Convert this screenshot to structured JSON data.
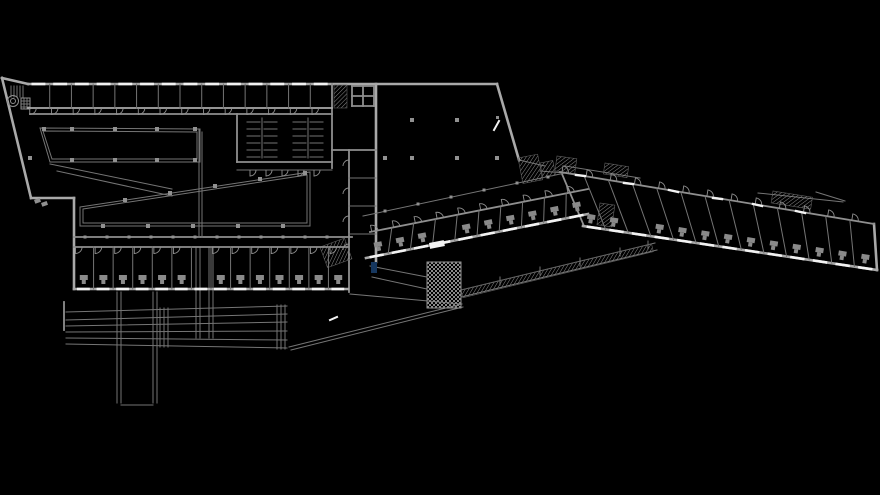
{
  "canvas": {
    "w": 880,
    "h": 495,
    "bg": "#000000"
  },
  "palette": {
    "thick": "#a9a9a9",
    "med": "#8f8f8f",
    "thin": "#757575",
    "faint": "#5e5e5e",
    "white": "#f2f2f2",
    "column": "#919191",
    "fixture": "#8a8a8a",
    "navy": "#16375f",
    "hatch": "#8a8a8a"
  },
  "walls": {
    "thick": [
      [
        2,
        78,
        28,
        84
      ],
      [
        28,
        84,
        497,
        84
      ],
      [
        2,
        78,
        31,
        198
      ],
      [
        31,
        198,
        74,
        198
      ],
      [
        74,
        198,
        74,
        289
      ],
      [
        497,
        84,
        519,
        160
      ],
      [
        376,
        84,
        376,
        262
      ],
      [
        874,
        224,
        877,
        270
      ]
    ],
    "med": [
      [
        30,
        114,
        332,
        114
      ],
      [
        237,
        114,
        237,
        162
      ],
      [
        237,
        162,
        332,
        162
      ],
      [
        332,
        84,
        332,
        168
      ],
      [
        332,
        150,
        376,
        150
      ],
      [
        349,
        150,
        349,
        292
      ],
      [
        74,
        237,
        352,
        237
      ],
      [
        64,
        302,
        64,
        330
      ],
      [
        562,
        174,
        584,
        226
      ],
      [
        352,
        86,
        352,
        106
      ],
      [
        374,
        86,
        374,
        106
      ],
      [
        352,
        86,
        374,
        86
      ],
      [
        352,
        106,
        374,
        106
      ],
      [
        363,
        86,
        363,
        106
      ],
      [
        352,
        96,
        374,
        96
      ]
    ],
    "thin": [
      [
        237,
        170,
        332,
        170
      ],
      [
        349,
        178,
        376,
        178
      ],
      [
        349,
        206,
        376,
        206
      ],
      [
        349,
        234,
        376,
        234
      ],
      [
        117,
        292,
        117,
        403
      ],
      [
        121,
        292,
        121,
        403
      ],
      [
        153,
        292,
        153,
        403
      ],
      [
        157,
        292,
        157,
        403
      ],
      [
        121,
        405,
        153,
        405
      ],
      [
        196,
        247,
        196,
        338
      ],
      [
        200,
        247,
        200,
        338
      ],
      [
        209,
        247,
        209,
        338
      ],
      [
        213,
        247,
        213,
        338
      ],
      [
        66,
        312,
        287,
        306
      ],
      [
        66,
        320,
        287,
        314
      ],
      [
        66,
        326,
        287,
        322
      ],
      [
        66,
        332,
        287,
        331
      ],
      [
        66,
        338,
        287,
        340
      ],
      [
        66,
        344,
        287,
        348
      ],
      [
        160,
        308,
        160,
        347
      ],
      [
        164,
        308,
        164,
        347
      ],
      [
        168,
        308,
        168,
        347
      ],
      [
        277,
        305,
        277,
        349
      ],
      [
        281,
        305,
        281,
        349
      ],
      [
        285,
        305,
        285,
        349
      ],
      [
        289,
        347,
        462,
        304
      ],
      [
        291,
        350,
        463,
        307
      ],
      [
        350,
        294,
        461,
        304
      ],
      [
        461,
        290,
        655,
        243
      ],
      [
        461,
        297,
        657,
        250
      ],
      [
        370,
        266,
        427,
        277
      ],
      [
        372,
        277,
        427,
        289
      ],
      [
        363,
        216,
        565,
        173
      ],
      [
        540,
        171,
        565,
        173
      ],
      [
        565,
        166,
        640,
        178
      ],
      [
        758,
        193,
        843,
        202
      ],
      [
        816,
        192,
        845,
        201
      ],
      [
        50,
        164,
        172,
        189
      ],
      [
        57,
        171,
        172,
        196
      ],
      [
        199,
        129,
        199,
        237
      ],
      [
        202,
        132,
        202,
        237
      ],
      [
        519,
        160,
        545,
        166
      ],
      [
        11,
        86,
        11,
        97
      ],
      [
        14,
        86,
        14,
        97
      ],
      [
        17,
        86,
        17,
        97
      ],
      [
        20,
        86,
        20,
        97
      ],
      [
        23,
        86,
        23,
        97
      ],
      [
        24,
        98,
        24,
        109
      ],
      [
        27,
        98,
        27,
        109
      ],
      [
        21,
        101,
        30,
        101
      ],
      [
        21,
        104,
        30,
        104
      ],
      [
        21,
        107,
        30,
        107
      ],
      [
        500,
        277,
        500,
        285
      ],
      [
        540,
        267,
        540,
        275
      ],
      [
        580,
        258,
        580,
        266
      ],
      [
        620,
        248,
        620,
        256
      ],
      [
        648,
        241,
        648,
        249
      ]
    ]
  },
  "bands": [
    {
      "name": "top-room-band",
      "top": [
        28,
        84,
        332,
        84
      ],
      "bottom": [
        28,
        108,
        332,
        108
      ],
      "n": 14,
      "topW": 0,
      "bottomW": 1.8,
      "doors": {
        "side": "bottom",
        "dir": "down",
        "skip": []
      },
      "windows": {
        "side": "top"
      },
      "fixtures": false
    },
    {
      "name": "left-wing-band",
      "top": [
        74,
        247,
        348,
        247
      ],
      "bottom": [
        74,
        289,
        348,
        289
      ],
      "n": 14,
      "topW": 1.8,
      "bottomW": 2.6,
      "doors": {
        "side": "top",
        "dir": "down",
        "skip": [
          6
        ]
      },
      "windows": {
        "side": "bottom"
      },
      "fixtures": {
        "skip": [
          6
        ]
      }
    },
    {
      "name": "middle-wing-band",
      "top": [
        370,
        232,
        588,
        189
      ],
      "bottom": [
        366,
        258,
        588,
        214
      ],
      "n": 10,
      "topW": 1.8,
      "bottomW": 2.6,
      "doors": {
        "side": "top",
        "dir": "up",
        "skip": []
      },
      "windows": {
        "side": "bottom"
      },
      "fixtures": {
        "skip": [
          3
        ]
      }
    },
    {
      "name": "right-wing-band",
      "top": [
        560,
        172,
        874,
        224
      ],
      "bottom": [
        583,
        226,
        877,
        270
      ],
      "n": 13,
      "topW": 1.8,
      "bottomW": 2.6,
      "doors": {
        "side": "top",
        "dir": "up",
        "skip": []
      },
      "windows": {
        "side": "bottom"
      },
      "fixtures": {
        "skip": [
          2
        ]
      }
    }
  ],
  "stalls": {
    "ys": [
      122,
      129,
      136,
      143,
      150,
      157
    ],
    "vy1": 118,
    "vy2": 158,
    "groups": [
      {
        "cx": 262,
        "x1": 247,
        "x2": 277
      },
      {
        "cx": 308,
        "x1": 293,
        "x2": 323
      }
    ]
  },
  "doors_extra": [
    [
      250,
      170,
      6,
      0,
      "down"
    ],
    [
      266,
      170,
      6,
      0,
      "down"
    ],
    [
      282,
      170,
      6,
      0,
      "down"
    ],
    [
      298,
      170,
      6,
      0,
      "down"
    ],
    [
      314,
      170,
      6,
      0,
      "down"
    ],
    [
      349,
      166,
      6,
      180,
      "down"
    ],
    [
      349,
      194,
      6,
      180,
      "down"
    ],
    [
      349,
      222,
      6,
      180,
      "down"
    ],
    [
      349,
      250,
      6,
      180,
      "down"
    ]
  ],
  "hatches": [
    [
      334,
      85,
      13,
      23,
      0,
      "dense"
    ],
    [
      427,
      262,
      34,
      46,
      0,
      "check"
    ],
    [
      320,
      247,
      26,
      22,
      -20,
      "dense"
    ],
    [
      600,
      203,
      15,
      22,
      8,
      "dense"
    ],
    [
      540,
      163,
      13,
      15,
      -11,
      "dense"
    ],
    [
      557,
      156,
      20,
      15,
      8,
      "dense"
    ],
    [
      518,
      158,
      20,
      26,
      -11,
      "dense"
    ],
    [
      605,
      163,
      24,
      11,
      9,
      "dense"
    ],
    [
      773,
      191,
      40,
      12,
      9,
      "dense"
    ],
    [
      461,
      290,
      196,
      8,
      -13.6,
      "dense"
    ]
  ],
  "outline_rects": [
    [
      21,
      98,
      9,
      11,
      0
    ],
    [
      427,
      262,
      34,
      46,
      0
    ]
  ],
  "columns": [
    [
      44,
      129
    ],
    [
      72,
      129
    ],
    [
      115,
      129
    ],
    [
      157,
      129
    ],
    [
      195,
      129
    ],
    [
      30,
      158
    ],
    [
      72,
      160
    ],
    [
      115,
      160
    ],
    [
      157,
      160
    ],
    [
      195,
      160
    ],
    [
      125,
      200
    ],
    [
      170,
      193
    ],
    [
      215,
      186
    ],
    [
      260,
      179
    ],
    [
      305,
      173
    ],
    [
      103,
      226
    ],
    [
      148,
      226
    ],
    [
      193,
      226
    ],
    [
      238,
      226
    ],
    [
      283,
      226
    ],
    [
      412,
      120
    ],
    [
      457,
      120
    ],
    [
      385,
      158
    ],
    [
      412,
      158
    ],
    [
      457,
      158
    ],
    [
      497,
      158
    ]
  ],
  "posts": [
    [
      85,
      237
    ],
    [
      107,
      237
    ],
    [
      129,
      237
    ],
    [
      151,
      237
    ],
    [
      173,
      237
    ],
    [
      195,
      237
    ],
    [
      217,
      237
    ],
    [
      239,
      237
    ],
    [
      261,
      237
    ],
    [
      283,
      237
    ],
    [
      305,
      237
    ],
    [
      327,
      237
    ],
    [
      385,
      211
    ],
    [
      418,
      204
    ],
    [
      451,
      197
    ],
    [
      484,
      190
    ],
    [
      517,
      183
    ],
    [
      548,
      177
    ]
  ],
  "windows_extra": [
    [
      576,
      175,
      585,
      176
    ],
    [
      624,
      183,
      633,
      184
    ],
    [
      669,
      190,
      678,
      192
    ],
    [
      713,
      198,
      722,
      199
    ],
    [
      753,
      204,
      762,
      206
    ],
    [
      796,
      211,
      805,
      213
    ]
  ],
  "white_marks": [
    [
      494,
      130,
      499,
      121
    ],
    [
      330,
      320,
      337,
      317
    ]
  ],
  "rects": {
    "navy": [
      [
        371,
        262,
        6,
        11,
        0
      ]
    ],
    "white": [
      [
        429,
        243,
        15,
        6,
        -11
      ]
    ],
    "gray": [
      [
        496,
        116,
        3,
        3,
        0
      ],
      [
        34,
        200,
        6,
        4,
        -20
      ],
      [
        41,
        203,
        6,
        4,
        -20
      ]
    ]
  },
  "circles": [
    [
      13,
      101,
      5.5
    ],
    [
      13,
      101,
      2.5
    ]
  ],
  "polygons": [
    {
      "name": "hall-opening-1-outer",
      "pts": "40,128 200,129 200,162 50,162"
    },
    {
      "name": "hall-opening-1-inner",
      "pts": "43,131 197,132 197,159 52,159"
    },
    {
      "name": "hall-opening-2-outer",
      "pts": "80,207 310,172 310,226 80,226"
    },
    {
      "name": "hall-opening-2-inner",
      "pts": "83,209 307,175 307,223 83,223"
    }
  ]
}
